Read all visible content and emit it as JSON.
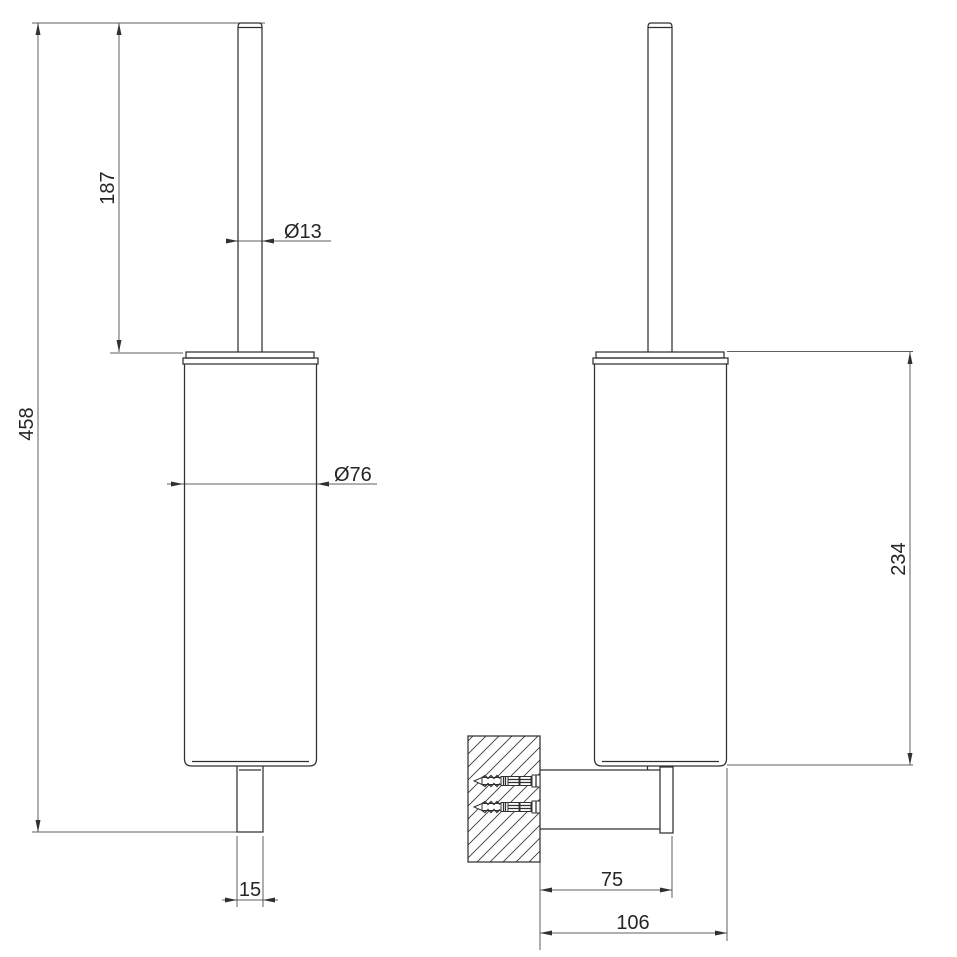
{
  "drawing": {
    "background": "#ffffff",
    "line_color": "#303030",
    "dimension_line_color": "#5f5f5f",
    "text_color": "#262626",
    "dimensions": {
      "total_height": "458",
      "handle_length": "187",
      "handle_diameter": "Ø13",
      "cup_diameter": "Ø76",
      "base_width": "15",
      "wall_cup_height": "234",
      "bracket_depth": "75",
      "total_depth": "106"
    }
  }
}
